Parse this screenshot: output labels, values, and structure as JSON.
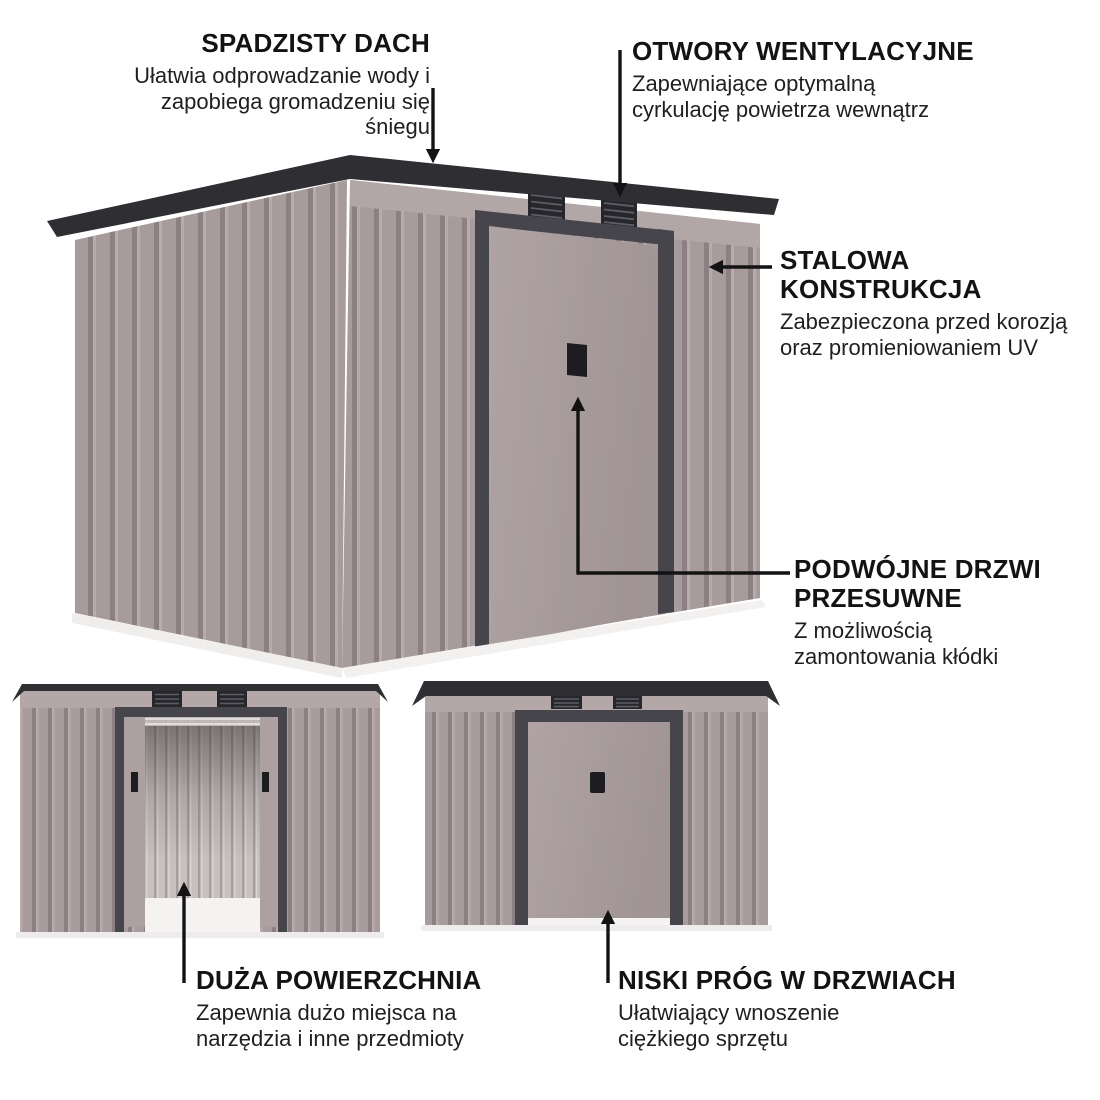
{
  "annotations": {
    "sloped_roof": {
      "title": "SPADZISTY DACH",
      "body": "Ułatwia odprowadzanie wody i\nzapobiega gromadzeniu się\nśniegu"
    },
    "vents": {
      "title": "OTWORY WENTYLACYJNE",
      "body": "Zapewniające optymalną\ncyrkulację powietrza wewnątrz"
    },
    "steel_structure": {
      "title": "STALOWA\nKONSTRUKCJA",
      "body": "Zabezpieczona przed korozją\noraz promieniowaniem UV"
    },
    "sliding_doors": {
      "title": "PODWÓJNE DRZWI\nPRZESUWNE",
      "body": "Z możliwością\nzamontowania kłódki"
    },
    "large_area": {
      "title": "DUŻA POWIERZCHNIA",
      "body": "Zapewnia dużo miejsca na\nnarzędzia i inne przedmioty"
    },
    "low_threshold": {
      "title": "NISKI PRÓG W DRZWIACH",
      "body": "Ułatwiający wnoszenie\nciężkiego sprzętu"
    }
  },
  "colors": {
    "background": "#ffffff",
    "wall": "#a89b9c",
    "wall_groove": "#8d8082",
    "wall_highlight": "#b7abac",
    "upper_band": "#b3a6a7",
    "roof_trim": "#2e2e33",
    "door_frame": "#45454b",
    "door_handle": "#1c1c21",
    "interior": "#c6c0bf",
    "base_sill": "#f3f1f0",
    "text": "#141414",
    "arrow": "#131313"
  }
}
